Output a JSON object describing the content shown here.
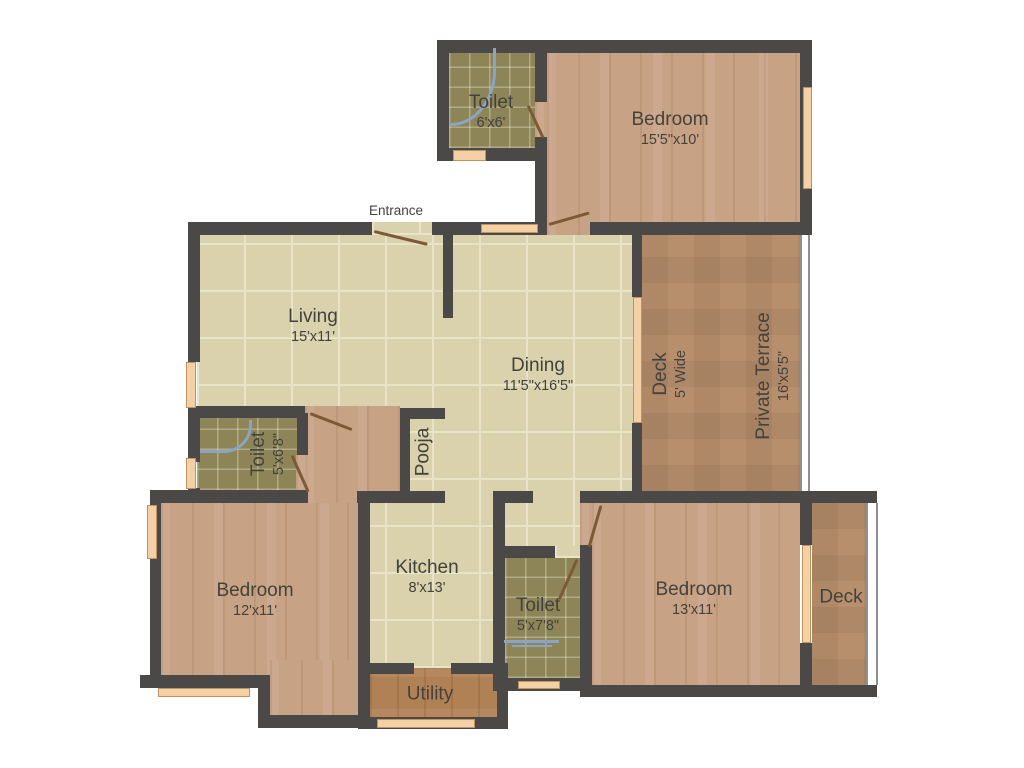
{
  "rooms": {
    "toilet_top": {
      "name": "Toilet",
      "dims": "6'x6'"
    },
    "bedroom_top": {
      "name": "Bedroom",
      "dims": "15'5\"x10'"
    },
    "living": {
      "name": "Living",
      "dims": "15'x11'"
    },
    "dining": {
      "name": "Dining",
      "dims": "11'5\"x16'5\""
    },
    "deck_side": {
      "name": "Deck",
      "dims": "5' Wide"
    },
    "private_terrace": {
      "name": "Private Terrace",
      "dims": "16'x5'5\""
    },
    "toilet_mid": {
      "name": "Toilet",
      "dims": "5'x6'8\""
    },
    "pooja": {
      "name": "Pooja"
    },
    "bedroom_left": {
      "name": "Bedroom",
      "dims": "12'x11'"
    },
    "kitchen": {
      "name": "Kitchen",
      "dims": "8'x13'"
    },
    "toilet_bottom": {
      "name": "Toilet",
      "dims": "5'x7'8\""
    },
    "utility": {
      "name": "Utility"
    },
    "bedroom_right": {
      "name": "Bedroom",
      "dims": "13'x11'"
    },
    "deck_bottom": {
      "name": "Deck"
    }
  },
  "annotations": {
    "entrance": "Entrance"
  },
  "colors": {
    "wall": "#4a4948",
    "tile_floor": "#d9d2ad",
    "bath_floor": "#8d8557",
    "wood_floor": "#c8a284",
    "terrace_floor": "#b88f6d",
    "utility_floor": "#b18156",
    "window": "#f4d0a6",
    "door_swing": "#7c5a38",
    "fixture": "#8ba4c4",
    "label_text": "#44423d"
  }
}
